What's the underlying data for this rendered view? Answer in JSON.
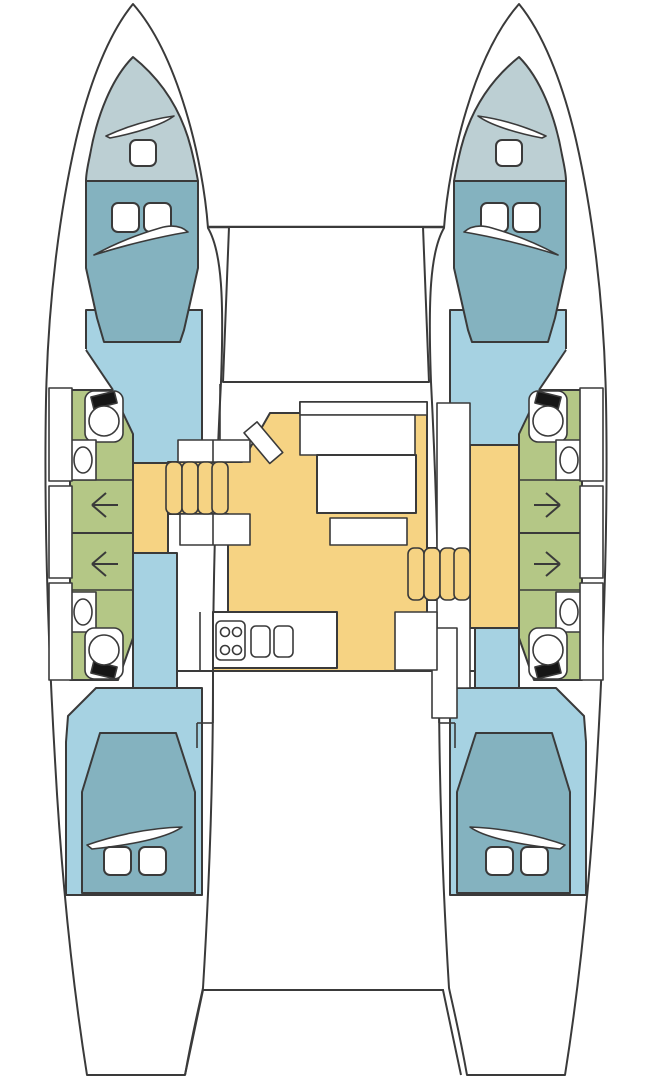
{
  "document": {
    "type": "boat-floorplan",
    "subject": "catamaran-deck-layout-top-view"
  },
  "palette": {
    "background": "#ffffff",
    "outline": "#3a3a3a",
    "hull": "#ffffff",
    "corridor_blue": "#a6d2e2",
    "cabin_teal": "#84b2bf",
    "forepeak_gray": "#bccfd3",
    "bathroom_green": "#b4c786",
    "salon_yellow": "#f6d383",
    "fixture_white": "#ffffff",
    "tank_black": "#161616"
  },
  "rooms": {
    "port_forepeak": "forepeak-berth",
    "port_forward_cabin": "forward-double-cabin",
    "port_heads": "bathrooms-with-shower",
    "port_aft_cabin": "aft-double-cabin",
    "starboard_forepeak": "forepeak-berth",
    "starboard_forward_cabin": "forward-double-cabin",
    "starboard_heads": "bathrooms-with-shower",
    "starboard_aft_cabin": "aft-double-cabin",
    "salon": "salon-and-galley",
    "foredeck": "foredeck",
    "cockpit": "aft-cockpit-platform"
  },
  "fixtures": {
    "stove_burners": 4,
    "galley_sinks": 2,
    "toilets": 4,
    "washbasins": 4,
    "shower_arrows": 4,
    "berth_pillows": 8,
    "companionway_steps_per_side": 4,
    "hull_side_lockers_per_side": 3
  }
}
